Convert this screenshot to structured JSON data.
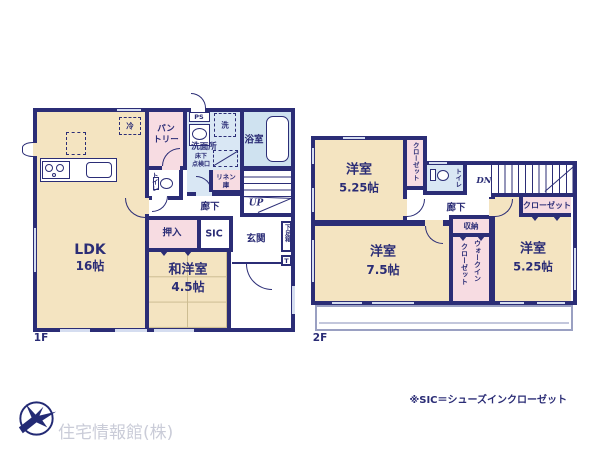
{
  "floor1": {
    "label": "1F",
    "ldk_name": "LDK",
    "ldk_size": "16帖",
    "wayou_name": "和洋室",
    "wayou_size": "4.5帖",
    "pantry1": "パン",
    "pantry2": "トリー",
    "ps": "PS",
    "washer": "洗",
    "senmenjo": "洗面所",
    "yukashita": "床下",
    "tenken": "点検口",
    "bath": "浴室",
    "linen1": "リネン",
    "linen2": "庫",
    "toilet": "トイレ",
    "rouka": "廊下",
    "up": "UP",
    "oshiire": "押入",
    "sic": "SIC",
    "genkan": "玄関",
    "getabako": "下足箱",
    "tbox": "T",
    "rei": "冷"
  },
  "floor2": {
    "label": "2F",
    "room_nw_name": "洋室",
    "room_nw_size": "5.25帖",
    "room_sw_name": "洋室",
    "room_sw_size": "7.5帖",
    "room_se_name": "洋室",
    "room_se_size": "5.25帖",
    "closet_nw": "クローゼット",
    "closet_e": "クローゼット",
    "toilet": "トイレ",
    "dn": "DN",
    "rouka": "廊下",
    "shuno": "収納",
    "wic1": "ウォークイン",
    "wic2": "クローゼット"
  },
  "footer": {
    "company": "住宅情報館(株)",
    "note": "※SIC＝シューズインクローゼット"
  },
  "colors": {
    "wall_navy": "#2b2d76",
    "room_cream": "#f4e4c1",
    "closet_pink": "#f7dce2",
    "wet_blue": "#d9e7f4",
    "window_blue": "#d5ddf0",
    "tatami_line": "#cdbd92",
    "logo_navy": "#232a74",
    "logo_text_gray": "#caccd8"
  }
}
